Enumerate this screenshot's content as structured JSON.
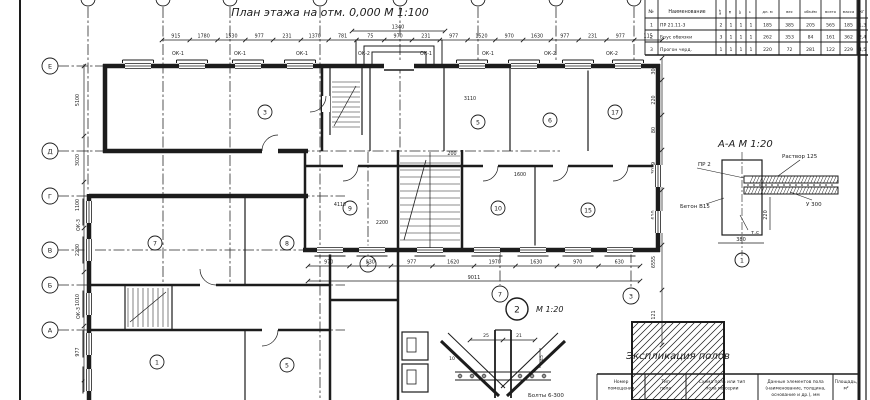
{
  "colors": {
    "ink": "#1c1c1c",
    "paper": "#ffffff"
  },
  "sheet": {
    "title": "План этажа на отм. 0,000  М 1:100"
  },
  "grid": {
    "left_labels": [
      "Е",
      "Д",
      "Г",
      "В",
      "Б",
      "А"
    ],
    "bottom_labels": [
      "2",
      "7",
      "3"
    ]
  },
  "dims": {
    "top_row": [
      "915",
      "1780",
      "1530",
      "977",
      "231",
      "1370",
      "781",
      "75",
      "970",
      "231",
      "977",
      "1520",
      "970",
      "1630",
      "977",
      "231",
      "977",
      "115"
    ],
    "top_total": "1340",
    "window_marks_top": [
      "ОК-1",
      "ОК-1",
      "ОК-1",
      "ОК-2",
      "ОК-1",
      "ОК-1",
      "ОК-2",
      "ОК-2"
    ],
    "window_marks_left": [
      "ОК-3",
      "ОК-3"
    ],
    "left_col": [
      "5100",
      "3020",
      "1100",
      "2230",
      "1010",
      "977"
    ],
    "right_col": [
      "300",
      "220",
      "80",
      "3019",
      "610",
      "6555",
      "121"
    ],
    "bottom_row": [
      "970",
      "930",
      "977",
      "1620",
      "1970",
      "1630",
      "970",
      "630"
    ],
    "bottom_total": "9011",
    "interior": [
      "3110",
      "2200",
      "200",
      "4110",
      "1600"
    ]
  },
  "rooms": [
    "3",
    "5",
    "6",
    "17",
    "9",
    "10",
    "15",
    "7",
    "8",
    "1",
    "5"
  ],
  "spec_table": {
    "header": {
      "num": "№",
      "name": "Наименование",
      "sub": [
        "шт",
        "м",
        "кг",
        "т"
      ],
      "vals": [
        "дл. м",
        "вес",
        "объём",
        "всего",
        "масса"
      ],
      "last": "кг"
    },
    "rows": [
      [
        "1",
        "ПР 21.11-3",
        "2",
        "1",
        "1",
        "1",
        "185",
        "385",
        "205",
        "565",
        "185",
        "1,3"
      ],
      [
        "2",
        "Брус обвязки",
        "3",
        "1",
        "1",
        "1",
        "262",
        "353",
        "84",
        "161",
        "362",
        "2,4"
      ],
      [
        "3",
        "Прогон черд.",
        "1",
        "1",
        "1",
        "1",
        "220",
        "72",
        "281",
        "122",
        "229",
        "4,5"
      ]
    ]
  },
  "section_aa": {
    "title": "А-А  М 1:20",
    "labels": {
      "top_left": "ПР 2",
      "top_right": "Раствор 125",
      "right": "У 300",
      "left": "Бетон В15",
      "inner": "т.с"
    },
    "dim_v": "220",
    "dim_b": "380",
    "axis": "1"
  },
  "node_detail": {
    "bubble": "2",
    "scale": "М 1:20",
    "dims": [
      "25",
      "21",
      "45",
      "10"
    ],
    "note": "Болты 6-300"
  },
  "explication": {
    "title": "Экспликация полов",
    "headers": [
      [
        "Номер",
        "помещения"
      ],
      [
        "Тип",
        "пола"
      ],
      [
        "Схема пола или тип",
        "пола по серии"
      ],
      [
        "Данные элементов пола",
        "(наименование, толщина,",
        "основание и др.), мм"
      ],
      [
        "Площадь,",
        "м²"
      ]
    ]
  }
}
